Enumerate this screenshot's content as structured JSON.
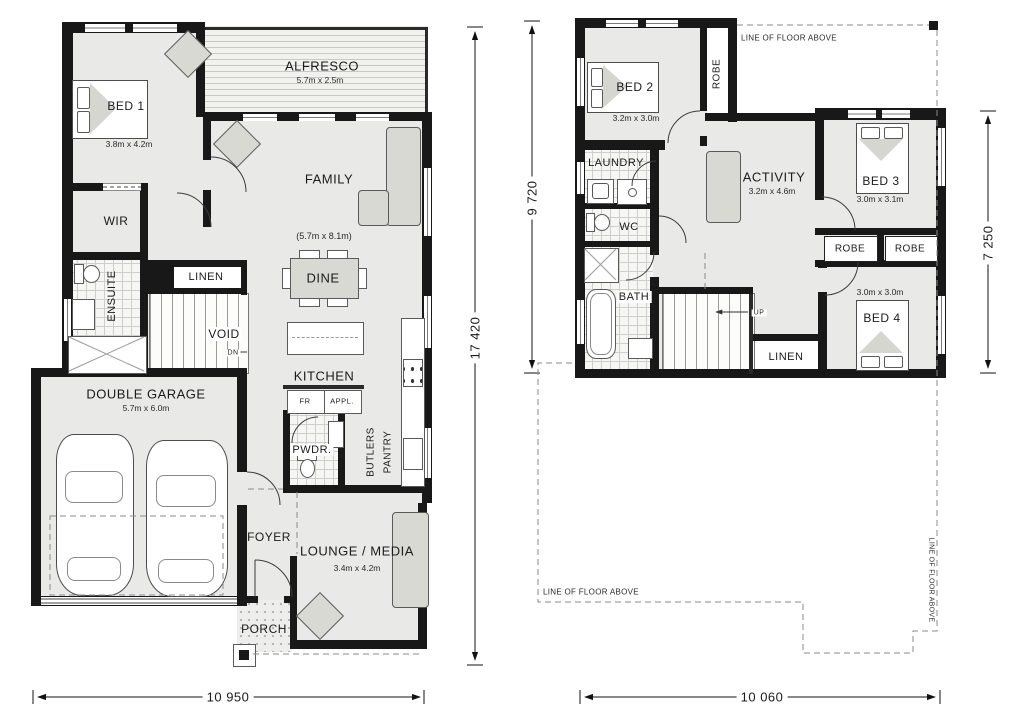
{
  "title": "Two storey home floor plan",
  "ground": {
    "bed1": {
      "name": "BED 1",
      "size": "3.8m x 4.2m"
    },
    "alfresco": {
      "name": "ALFRESCO",
      "size": "5.7m x 2.5m"
    },
    "family": {
      "name": "FAMILY",
      "size": "(5.7m x 8.1m)"
    },
    "wir": {
      "name": "WIR"
    },
    "ensuite": {
      "name": "ENSUITE"
    },
    "linen": {
      "name": "LINEN"
    },
    "void": {
      "name": "VOID"
    },
    "dn": "DN",
    "dine": {
      "name": "DINE"
    },
    "kitchen": {
      "name": "KITCHEN"
    },
    "fr": "FR",
    "appl": "APPL.",
    "pwdr": {
      "name": "PWDR."
    },
    "butlers": {
      "line1": "BUTLERS",
      "line2": "PANTRY"
    },
    "garage": {
      "name": "DOUBLE GARAGE",
      "size": "5.7m x 6.0m"
    },
    "foyer": {
      "name": "FOYER"
    },
    "lounge": {
      "name": "LOUNGE / MEDIA",
      "size": "3.4m x 4.2m"
    },
    "porch": {
      "name": "PORCH"
    },
    "dim_width": "10 950",
    "dim_height": "17 420"
  },
  "upper": {
    "bed2": {
      "name": "BED 2",
      "size": "3.2m x 3.0m"
    },
    "robe_bed2": "ROBE",
    "laundry": {
      "name": "LAUNDRY"
    },
    "wc": {
      "name": "WC"
    },
    "bath": {
      "name": "BATH"
    },
    "activity": {
      "name": "ACTIVITY",
      "size": "3.2m x 4.6m"
    },
    "bed3": {
      "name": "BED 3",
      "size": "3.0m x 3.1m"
    },
    "robe_left": "ROBE",
    "robe_right": "ROBE",
    "bed4": {
      "name": "BED 4",
      "size": "3.0m x 3.0m"
    },
    "linen": {
      "name": "LINEN"
    },
    "up": "UP",
    "floor_above_top": "LINE OF FLOOR ABOVE",
    "floor_above_left": "LINE OF FLOOR ABOVE",
    "floor_above_right": "LINE OF FLOOR ABOVE",
    "dim_width": "10 060",
    "dim_height_left": "9 720",
    "dim_height_right": "7 250"
  }
}
